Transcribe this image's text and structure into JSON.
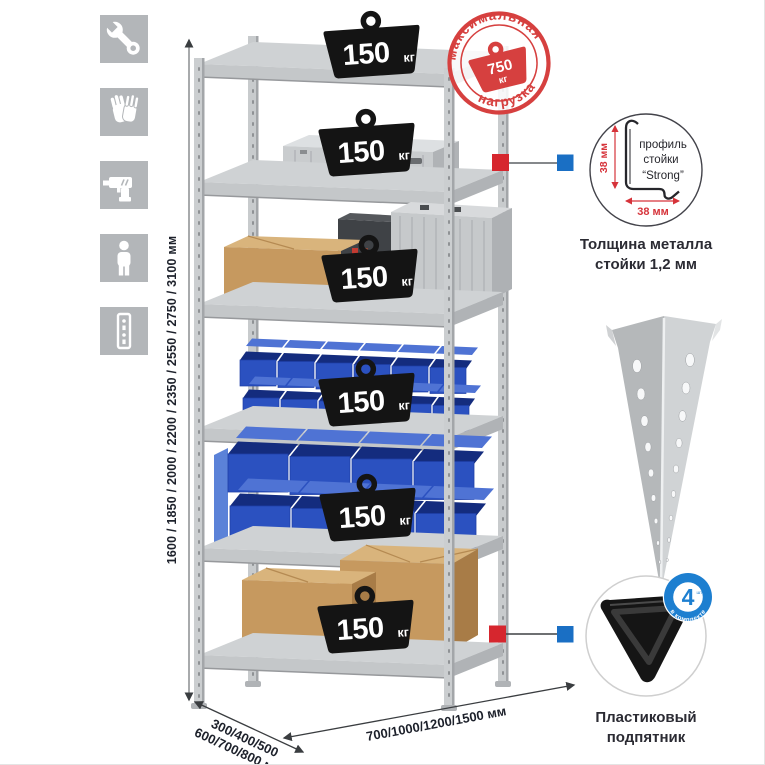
{
  "features": {
    "icons": [
      {
        "name": "wrench-icon"
      },
      {
        "name": "gloves-icon"
      },
      {
        "name": "drill-icon"
      },
      {
        "name": "person-icon"
      },
      {
        "name": "rack-post-icon"
      }
    ]
  },
  "dimensions": {
    "height_label": "1600 / 1850 / 2000 / 2200 / 2350 / 2550 / 2750 / 3100 мм",
    "depth_label_line1": "300/400/500",
    "depth_label_line2": "600/700/800 мм",
    "width_label": "700/1000/1200/1500 мм"
  },
  "rack": {
    "badges": [
      {
        "value": "150",
        "unit": "кг"
      },
      {
        "value": "150",
        "unit": "кг"
      },
      {
        "value": "150",
        "unit": "кг"
      },
      {
        "value": "150",
        "unit": "кг"
      },
      {
        "value": "150",
        "unit": "кг"
      },
      {
        "value": "150",
        "unit": "кг"
      }
    ]
  },
  "max_load_stamp": {
    "arc_top": "максимальная",
    "arc_bottom": "нагрузка",
    "value": "750",
    "unit": "кг",
    "color": "#d6403f"
  },
  "profile_detail": {
    "vertical_dim": "38 мм",
    "horizontal_dim": "38 мм",
    "label_line1": "профиль",
    "label_line2": "стойки",
    "label_line3": "“Strong”",
    "caption_line1": "Толщина металла",
    "caption_line2": "стойки 1,2 мм"
  },
  "foot_detail": {
    "badge_value": "4",
    "badge_qty_word": "штуки",
    "badge_arc": "в комплекте",
    "caption_line1": "Пластиковый",
    "caption_line2": "подпятник"
  },
  "colors": {
    "stamp_red": "#d6403f",
    "callout_red": "#d6262e",
    "callout_blue": "#1a6fc4",
    "kit_badge_blue": "#1d7fd0",
    "bin_blue": "#2b51c0",
    "metal_gray": "#c6c9cb",
    "icon_tile_gray": "#b3b6b9"
  }
}
